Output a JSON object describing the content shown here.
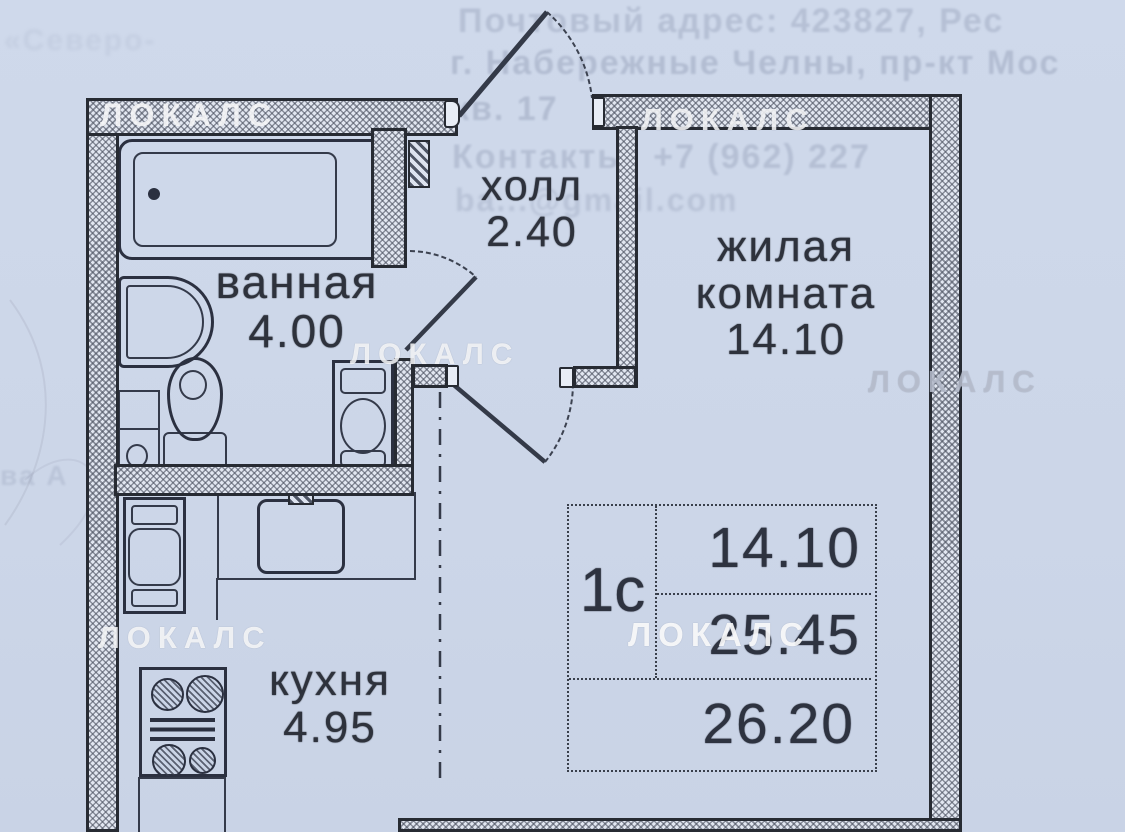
{
  "watermark": {
    "text": "ЛОКАЛС"
  },
  "rooms": {
    "bathroom": {
      "name": "ванная",
      "area": "4.00"
    },
    "hall": {
      "name": "холл",
      "area": "2.40"
    },
    "living": {
      "name_line1": "жилая",
      "name_line2": "комната",
      "area": "14.10"
    },
    "kitchen": {
      "name": "кухня",
      "area": "4.95"
    }
  },
  "summary_table": {
    "unit_type": "1с",
    "living_area": "14.10",
    "apartment_area": "25.45",
    "total_area": "26.20"
  },
  "ghost_text": {
    "line1": "Почтовый адрес: 423827, Рес",
    "line2": "г. Набережные Челны, пр-кт Мос",
    "line3": "кв. 17",
    "line4": "Контакты: +7 (962) 227",
    "line5": "ba...@gmail.com",
    "corner_fragment": "«Северо-",
    "left_fragment": "ва А"
  },
  "colors": {
    "paper": "#ccd6e8",
    "wall_dark": "#272b33",
    "hatch_gray": "#4a505f",
    "label_text": "#2e323c",
    "watermark_white": "#ffffff"
  }
}
